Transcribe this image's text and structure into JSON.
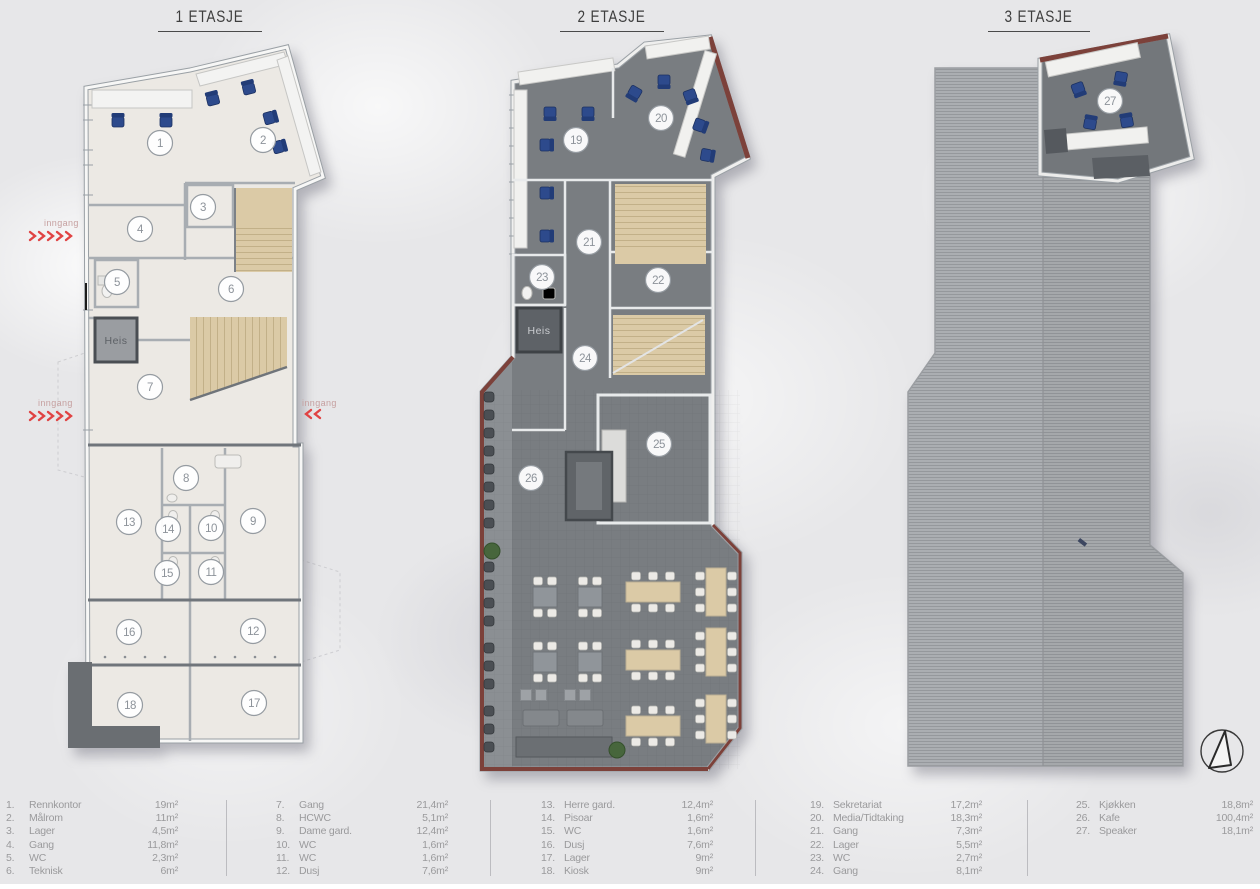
{
  "titles": {
    "floor1": "1 ETASJE",
    "floor2": "2 ETASJE",
    "floor3": "3 ETASJE"
  },
  "labels": {
    "heis": "Heis",
    "inngang": "inngang"
  },
  "legend": {
    "columns": [
      {
        "items": [
          {
            "num": "1.",
            "name": "Rennkontor",
            "area": "19m²"
          },
          {
            "num": "2.",
            "name": "Målrom",
            "area": "11m²"
          },
          {
            "num": "3.",
            "name": "Lager",
            "area": "4,5m²"
          },
          {
            "num": "4.",
            "name": "Gang",
            "area": "11,8m²"
          },
          {
            "num": "5.",
            "name": "WC",
            "area": "2,3m²"
          },
          {
            "num": "6.",
            "name": "Teknisk",
            "area": "6m²"
          }
        ]
      },
      {
        "items": [
          {
            "num": "7.",
            "name": "Gang",
            "area": "21,4m²"
          },
          {
            "num": "8.",
            "name": "HCWC",
            "area": "5,1m²"
          },
          {
            "num": "9.",
            "name": "Dame gard.",
            "area": "12,4m²"
          },
          {
            "num": "10.",
            "name": "WC",
            "area": "1,6m²"
          },
          {
            "num": "11.",
            "name": "WC",
            "area": "1,6m²"
          },
          {
            "num": "12.",
            "name": "Dusj",
            "area": "7,6m²"
          }
        ]
      },
      {
        "items": [
          {
            "num": "13.",
            "name": "Herre gard.",
            "area": "12,4m²"
          },
          {
            "num": "14.",
            "name": "Pisoar",
            "area": "1,6m²"
          },
          {
            "num": "15.",
            "name": "WC",
            "area": "1,6m²"
          },
          {
            "num": "16.",
            "name": "Dusj",
            "area": "7,6m²"
          },
          {
            "num": "17.",
            "name": "Lager",
            "area": "9m²"
          },
          {
            "num": "18.",
            "name": "Kiosk",
            "area": "9m²"
          }
        ]
      },
      {
        "items": [
          {
            "num": "19.",
            "name": "Sekretariat",
            "area": "17,2m²"
          },
          {
            "num": "20.",
            "name": "Media/Tidtaking",
            "area": "18,3m²"
          },
          {
            "num": "21.",
            "name": "Gang",
            "area": "7,3m²"
          },
          {
            "num": "22.",
            "name": "Lager",
            "area": "5,5m²"
          },
          {
            "num": "23.",
            "name": "WC",
            "area": "2,7m²"
          },
          {
            "num": "24.",
            "name": "Gang",
            "area": "8,1m²"
          }
        ]
      },
      {
        "items": [
          {
            "num": "25.",
            "name": "Kjøkken",
            "area": "18,8m²"
          },
          {
            "num": "26.",
            "name": "Kafe",
            "area": "100,4m²"
          },
          {
            "num": "27.",
            "name": "Speaker",
            "area": "18,1m²"
          }
        ]
      }
    ]
  },
  "markers": {
    "floor1": [
      {
        "n": "1",
        "x": 160,
        "y": 143
      },
      {
        "n": "2",
        "x": 263,
        "y": 140
      },
      {
        "n": "3",
        "x": 203,
        "y": 207
      },
      {
        "n": "4",
        "x": 140,
        "y": 229
      },
      {
        "n": "5",
        "x": 117,
        "y": 282
      },
      {
        "n": "6",
        "x": 231,
        "y": 289
      },
      {
        "n": "7",
        "x": 150,
        "y": 387
      },
      {
        "n": "8",
        "x": 186,
        "y": 478
      },
      {
        "n": "9",
        "x": 253,
        "y": 521
      },
      {
        "n": "10",
        "x": 211,
        "y": 528
      },
      {
        "n": "11",
        "x": 211,
        "y": 572
      },
      {
        "n": "12",
        "x": 253,
        "y": 631
      },
      {
        "n": "13",
        "x": 129,
        "y": 522
      },
      {
        "n": "14",
        "x": 168,
        "y": 529
      },
      {
        "n": "15",
        "x": 167,
        "y": 573
      },
      {
        "n": "16",
        "x": 129,
        "y": 632
      },
      {
        "n": "17",
        "x": 254,
        "y": 703
      },
      {
        "n": "18",
        "x": 130,
        "y": 705
      }
    ],
    "floor2": [
      {
        "n": "19",
        "x": 576,
        "y": 140
      },
      {
        "n": "20",
        "x": 661,
        "y": 118
      },
      {
        "n": "21",
        "x": 589,
        "y": 242
      },
      {
        "n": "22",
        "x": 658,
        "y": 280
      },
      {
        "n": "23",
        "x": 542,
        "y": 277
      },
      {
        "n": "24",
        "x": 585,
        "y": 358
      },
      {
        "n": "25",
        "x": 659,
        "y": 444
      },
      {
        "n": "26",
        "x": 531,
        "y": 478
      }
    ],
    "floor3": [
      {
        "n": "27",
        "x": 1110,
        "y": 101
      }
    ]
  },
  "colors": {
    "red_arrow": "#e04343",
    "roof_edge": "#7c413a",
    "chair_blue": "#2d4a8c",
    "stair_beige": "#dbcaa6",
    "carpet_dark": "#797d81",
    "floor_light": "#ece9e4"
  }
}
